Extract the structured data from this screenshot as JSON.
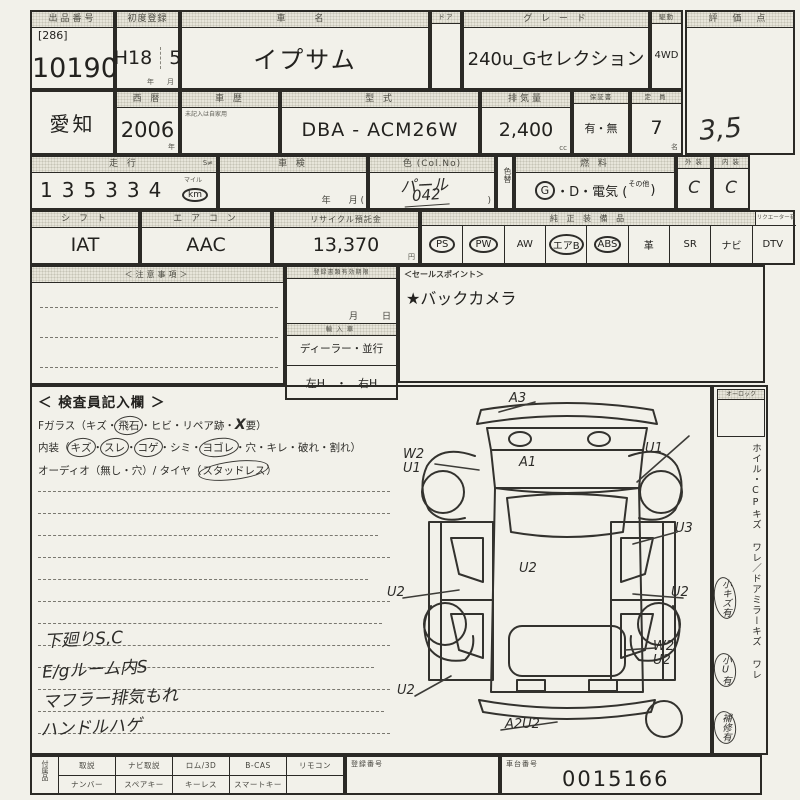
{
  "colors": {
    "paper": "#f2f1ea",
    "ink": "#2b2a26"
  },
  "sheet": {
    "lot": {
      "label": "出品番号",
      "bracket": "[286]",
      "number": "10190"
    },
    "first_reg": {
      "label": "初度登録",
      "era": "H18",
      "month": "5",
      "unit_year": "年",
      "unit_month": "月"
    },
    "car": {
      "label": "車　名",
      "name": "イプサム"
    },
    "door": {
      "label": "ドア"
    },
    "grade": {
      "label": "グ レ ー ド",
      "value": "240u_Gセレクション"
    },
    "drive": {
      "label": "駆動",
      "value": "4WD"
    },
    "score": {
      "label": "評 価 点",
      "value": "3,5"
    },
    "region": {
      "value": "愛知"
    },
    "year": {
      "label": "西 暦",
      "value": "2006",
      "unit": "年"
    },
    "history": {
      "label": "車 歴",
      "note": "未記入は自家用"
    },
    "model": {
      "label": "型 式",
      "value": "DBA - ACM26W"
    },
    "displacement": {
      "label": "排気量",
      "value": "2,400",
      "unit": "cc"
    },
    "warranty": {
      "label": "保証書",
      "value": "有・無"
    },
    "capacity": {
      "label": "定 員",
      "value": "7",
      "unit": "名"
    },
    "mileage": {
      "label": "走 行",
      "meter_mark": "S≠",
      "value": "135334",
      "unit_top": "マイル",
      "unit": "km"
    },
    "shaken": {
      "label": "車 検",
      "units": "年　　月 ("
    },
    "color": {
      "label": "色 (Col.No)",
      "value": "パール",
      "code": "042",
      "close_paren": ")"
    },
    "color_change": {
      "label": "色替"
    },
    "fuel": {
      "label": "燃 料",
      "gas": "G",
      "rest": "・D・電気 (",
      "other": "その他",
      "close": ")"
    },
    "exterior": {
      "label": "外 装",
      "value": "C"
    },
    "interior": {
      "label": "内 装",
      "value": "C"
    },
    "shift": {
      "label": "シ フ ト",
      "value": "IAT"
    },
    "aircon": {
      "label": "エ ア コ ン",
      "value": "AAC"
    },
    "recycle": {
      "label": "リサイクル預託金",
      "value": "13,370",
      "unit": "円"
    },
    "equipment": {
      "label": "純 正 装 備 品",
      "dtv_note": "リクエーター有",
      "items": [
        {
          "label": "PS",
          "circled": true
        },
        {
          "label": "PW",
          "circled": true
        },
        {
          "label": "AW",
          "circled": false
        },
        {
          "label": "エアB",
          "circled": true
        },
        {
          "label": "ABS",
          "circled": true
        },
        {
          "label": "革",
          "circled": false
        },
        {
          "label": "SR",
          "circled": false
        },
        {
          "label": "ナビ",
          "circled": false
        },
        {
          "label": "DTV",
          "circled": false
        }
      ]
    },
    "notes": {
      "label": "＜注意事項＞"
    },
    "docs": {
      "label": "登録書類有効期限",
      "month": "月",
      "day": "日",
      "import_label": "輸入車",
      "import_type": "ディーラー・並行",
      "handle": "左H　・　右H"
    },
    "sales": {
      "label": "＜セールスポイント＞",
      "point": "★バックカメラ"
    },
    "inspector": {
      "title": "＜ 検査員記入欄 ＞",
      "glass": {
        "s1": "Fガラス（キズ・",
        "c1": "飛石",
        "s2": "・ヒビ・リペア跡・",
        "x": "X",
        "s3": "要）"
      },
      "interior_line": {
        "s1": "内装（",
        "w1": "キズ",
        "d1": "・",
        "w2": "スレ",
        "d2": "・",
        "w3": "コゲ",
        "d3": "・シミ・",
        "w4": "ヨゴレ",
        "d4": "・穴・キレ・破れ・割れ）"
      },
      "audio_line": {
        "s1": "オーディオ（無し・穴）/ タイヤ（",
        "w1": "スタッドレス",
        "s2": "）"
      },
      "hand_notes": [
        "下廻りS,C",
        "E/gルーム内S",
        "マフラー排気もれ",
        "ハンドルハゲ"
      ]
    },
    "diagram": {
      "marks": [
        {
          "text": "A3"
        },
        {
          "text": "W2",
          "text2": "U1"
        },
        {
          "text": "A1"
        },
        {
          "text": "U1"
        },
        {
          "text": "U3"
        },
        {
          "text": "U2"
        },
        {
          "text": "U2"
        },
        {
          "text": "U2"
        },
        {
          "text": "W2",
          "text2": "U2"
        },
        {
          "text": "U2"
        },
        {
          "text": "A2U2"
        }
      ]
    },
    "sidebar": {
      "lock_label": "オーロック",
      "damage_line1": "ホイル・CPキズ ワレ",
      "slash": "／",
      "damage_line2": "ドアミラーキズ ワレ",
      "tag_small_scratch": "小キズ有",
      "tag_small_dent": "小U有",
      "tag_repair": "補修有"
    },
    "bottom": {
      "accessories_label": "付属品",
      "row1": [
        "取説",
        "ナビ取説",
        "ロム/3D",
        "B-CAS",
        "リモコン"
      ],
      "row2": [
        "ナンバー",
        "スペアキー",
        "キーレス",
        "スマートキー"
      ],
      "reg_label": "登録番号",
      "chassis_label": "車台番号",
      "chassis_number": "0015166"
    }
  }
}
